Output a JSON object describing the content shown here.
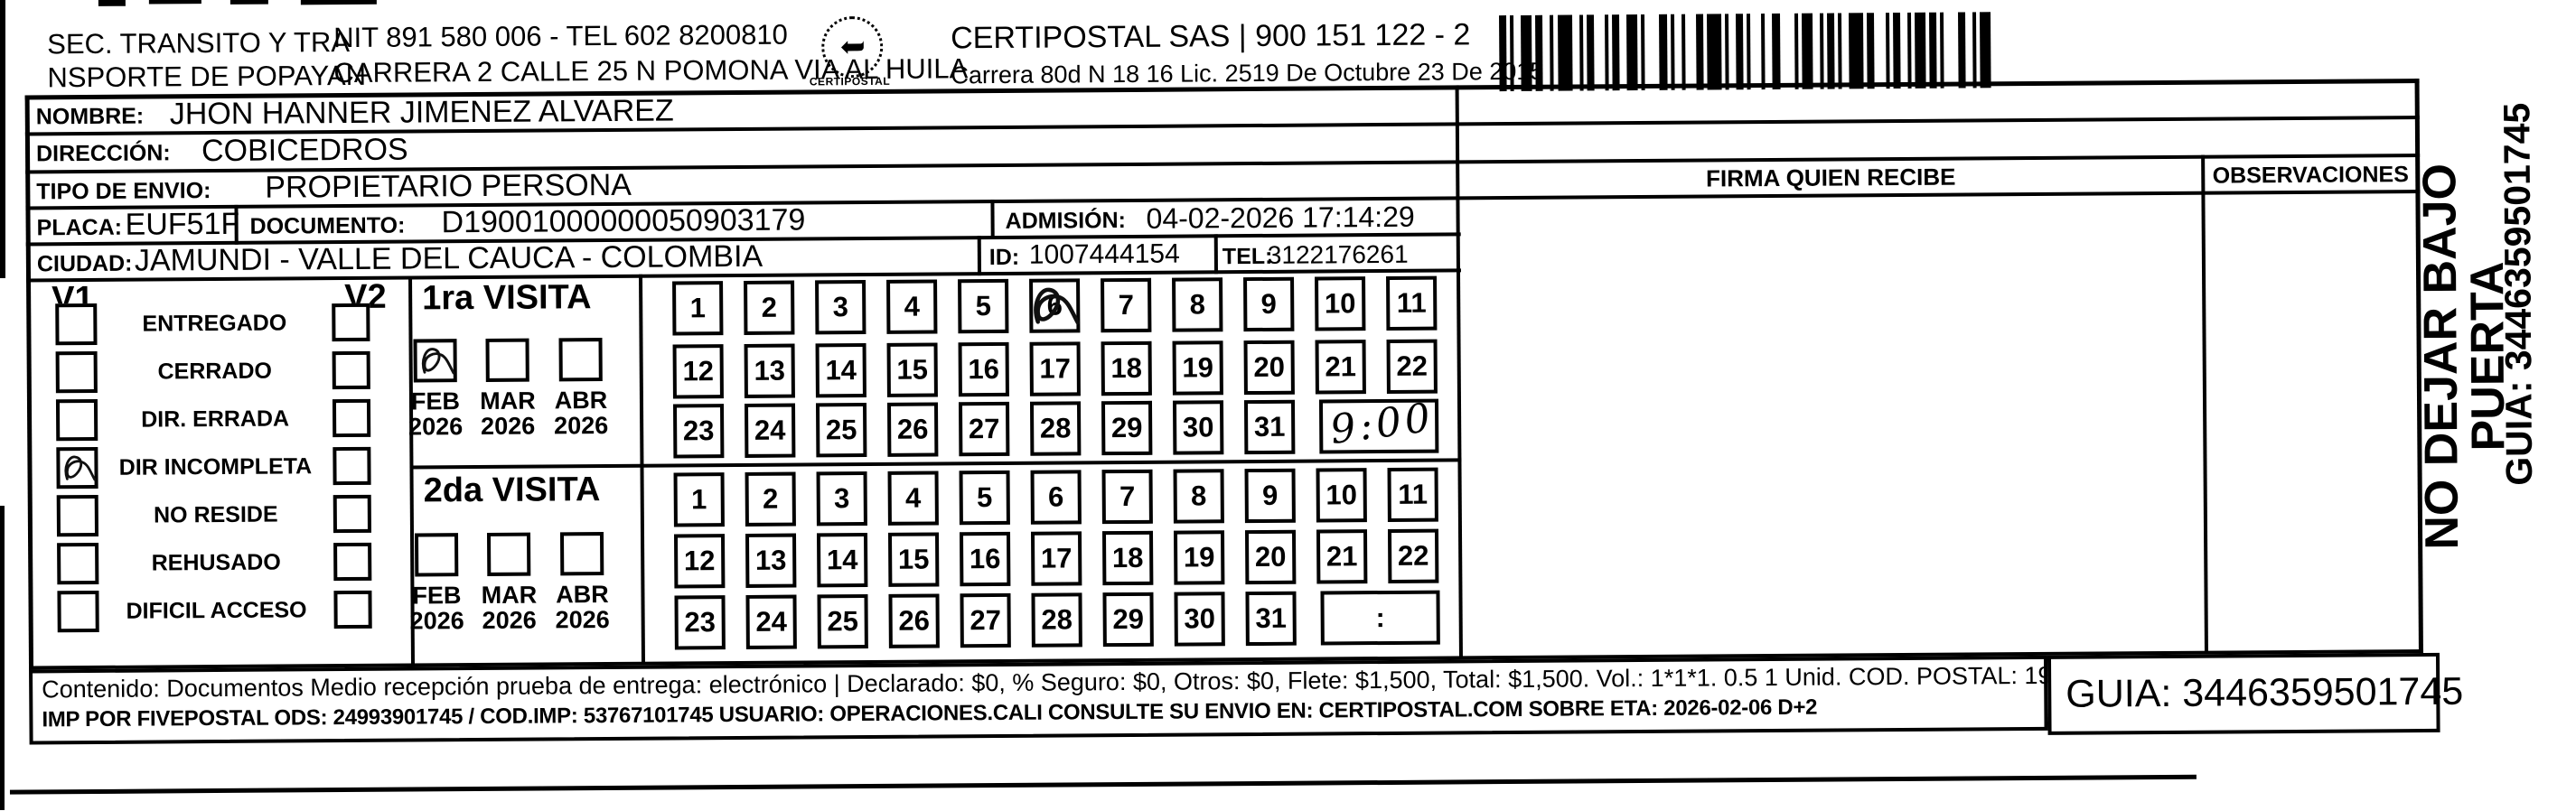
{
  "header": {
    "sender_line1": "SEC. TRANSITO Y TRA",
    "sender_line2": "NSPORTE DE POPAYAN",
    "nit_tel": "NIT 891 580 006 - TEL 602 8200810",
    "sender_address": "CARRERA 2 CALLE 25 N POMONA VIA AL HUILA",
    "logo_text": "CERTIPOSTAL",
    "company": "CERTIPOSTAL SAS | 900 151 122 - 2",
    "company_address": "Carrera 80d N 18 16  Lic. 2519 De Octubre 23 De 2015",
    "top_cut_text": "3446359501745"
  },
  "recipient": {
    "nombre_label": "NOMBRE:",
    "nombre": "JHON HANNER JIMENEZ ALVAREZ",
    "direccion_label": "DIRECCIÓN:",
    "direccion": "COBICEDROS",
    "tipo_label": "TIPO DE ENVIO:",
    "tipo": "PROPIETARIO PERSONA",
    "placa_label": "PLACA:",
    "placa": "EUF51F",
    "documento_label": "DOCUMENTO:",
    "documento": "D19001000000050903179",
    "admision_label": "ADMISIÓN:",
    "admision": "04-02-2026 17:14:29",
    "ciudad_label": "CIUDAD:",
    "ciudad": "JAMUNDI - VALLE DEL CAUCA - COLOMBIA",
    "id_label": "ID:",
    "id_value": "1007444154",
    "tel_label": "TEL:",
    "tel": "3122176261"
  },
  "status": {
    "v1_label": "V1",
    "v2_label": "V2",
    "options": [
      {
        "label": "ENTREGADO",
        "v1": false,
        "v2": false
      },
      {
        "label": "CERRADO",
        "v1": false,
        "v2": false
      },
      {
        "label": "DIR. ERRADA",
        "v1": false,
        "v2": false
      },
      {
        "label": "DIR INCOMPLETA",
        "v1": true,
        "v2": false
      },
      {
        "label": "NO RESIDE",
        "v1": false,
        "v2": false
      },
      {
        "label": "REHUSADO",
        "v1": false,
        "v2": false
      },
      {
        "label": "DIFICIL ACCESO",
        "v1": false,
        "v2": false
      }
    ]
  },
  "visits": {
    "day_rows": [
      [
        "1",
        "2",
        "3",
        "4",
        "5",
        "6",
        "7",
        "8",
        "9",
        "10",
        "11"
      ],
      [
        "12",
        "13",
        "14",
        "15",
        "16",
        "17",
        "18",
        "19",
        "20",
        "21",
        "22"
      ],
      [
        "23",
        "24",
        "25",
        "26",
        "27",
        "28",
        "29",
        "30",
        "31"
      ]
    ],
    "first": {
      "title": "1ra VISITA",
      "months": [
        {
          "month": "FEB",
          "year": "2026",
          "checked": true
        },
        {
          "month": "MAR",
          "year": "2026",
          "checked": false
        },
        {
          "month": "ABR",
          "year": "2026",
          "checked": false
        }
      ],
      "marked_day": "6",
      "time_handwritten": "9:00",
      "time_separator": ":"
    },
    "second": {
      "title": "2da VISITA",
      "months": [
        {
          "month": "FEB",
          "year": "2026",
          "checked": false
        },
        {
          "month": "MAR",
          "year": "2026",
          "checked": false
        },
        {
          "month": "ABR",
          "year": "2026",
          "checked": false
        }
      ],
      "marked_day": null,
      "time_handwritten": "",
      "time_separator": ":"
    }
  },
  "signature": {
    "firma_label": "FIRMA QUIEN RECIBE",
    "observaciones_label": "OBSERVACIONES"
  },
  "side": {
    "warning": "NO DEJAR BAJO PUERTA",
    "guia": "GUIA: 3446359501745"
  },
  "footer": {
    "line1": "Contenido: Documentos Medio recepción prueba de entrega: electrónico | Declarado: $0, % Seguro: $0, Otros: $0, Flete: $1,500, Total: $1,500. Vol.: 1*1*1. 0.5  1 Unid. COD. POSTAL: 190004",
    "line2": "IMP POR FIVEPOSTAL ODS: 24993901745 / COD.IMP: 53767101745 USUARIO: OPERACIONES.CALI CONSULTE SU ENVIO EN: CERTIPOSTAL.COM SOBRE ETA: 2026-02-06 D+2",
    "guia_box": "GUIA: 3446359501745"
  }
}
